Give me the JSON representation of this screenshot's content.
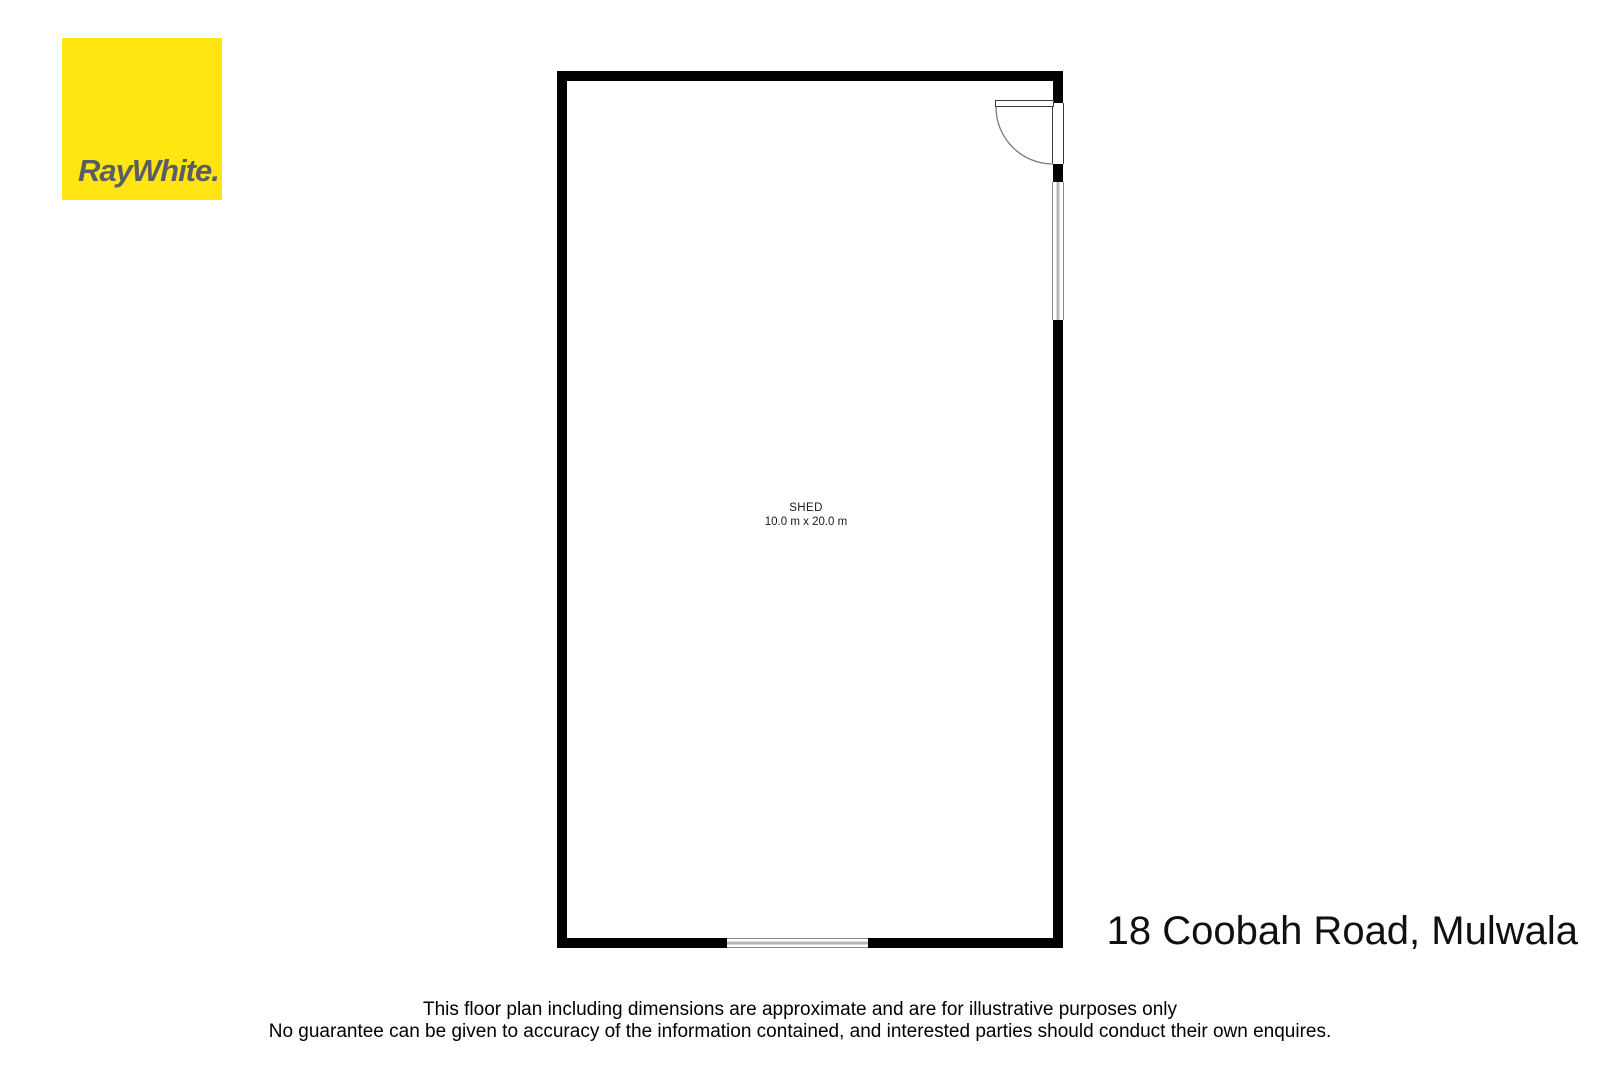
{
  "logo": {
    "brand_wordmark": "RayWhite."
  },
  "floor_plan": {
    "room_label": "SHED",
    "room_dimensions": "10.0 m x 20.0 m",
    "features": {
      "door": "single-swing-door-top-right",
      "window_right_wall": "window",
      "window_bottom_wall": "window"
    }
  },
  "address_caption": "18 Coobah Road, Mulwala",
  "disclaimer_line1": "This floor plan including dimensions are approximate and are for illustrative purposes only",
  "disclaimer_line2": "No guarantee can be given to accuracy of the information contained, and interested parties should conduct their own enquires.",
  "colors": {
    "brand_yellow": "#FFE512",
    "brand_gray": "#5A5E62",
    "wall_black": "#000000",
    "window_gray": "#b5b5b5",
    "background": "#ffffff"
  }
}
